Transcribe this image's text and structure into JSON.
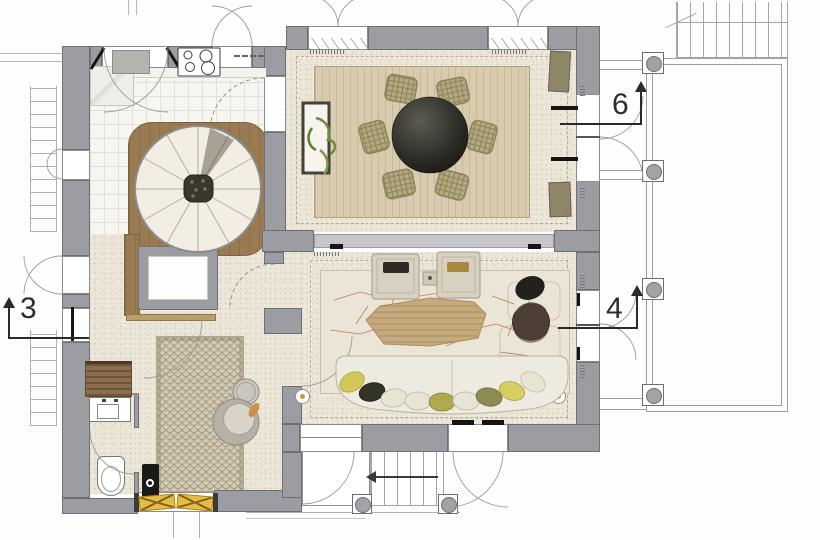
{
  "plan": {
    "kind": "architectural-floor-plan",
    "section_markers": [
      {
        "label": "3",
        "direction": "up"
      },
      {
        "label": "4",
        "direction": "up"
      },
      {
        "label": "6",
        "direction": "up"
      }
    ],
    "elements": {
      "icons": [
        "spiral-staircase",
        "elevator",
        "dining-table",
        "dining-chair",
        "plant-console",
        "cooktop",
        "kitchen-sink",
        "kitchen-counter",
        "sofa",
        "coffee-table",
        "armchair",
        "stone-pouf",
        "barrel-chair",
        "side-table",
        "entry-rug",
        "lounge-chair",
        "round-side-table",
        "wood-stove",
        "bench",
        "vanity-sink",
        "toilet",
        "terrace-column",
        "terrace-railing",
        "exterior-stair",
        "entry-door",
        "window",
        "door-swing"
      ]
    },
    "colors": {
      "wall": "#9c9ca3",
      "wall_line": "#6f6f77",
      "floor": "#ece7d9",
      "tile": "#f7f6f1",
      "wood": "#9a7a50",
      "rug_dining": "#d9cbae",
      "rug_living": "#ebe5d8",
      "rug_entry": "#d3cab4",
      "door_yellow": "#e9bb41",
      "table_dark": "#23221e",
      "chair_olive": "#b2a97c",
      "crackle": "#ad6b46",
      "marker": "#2a2a2a"
    }
  }
}
